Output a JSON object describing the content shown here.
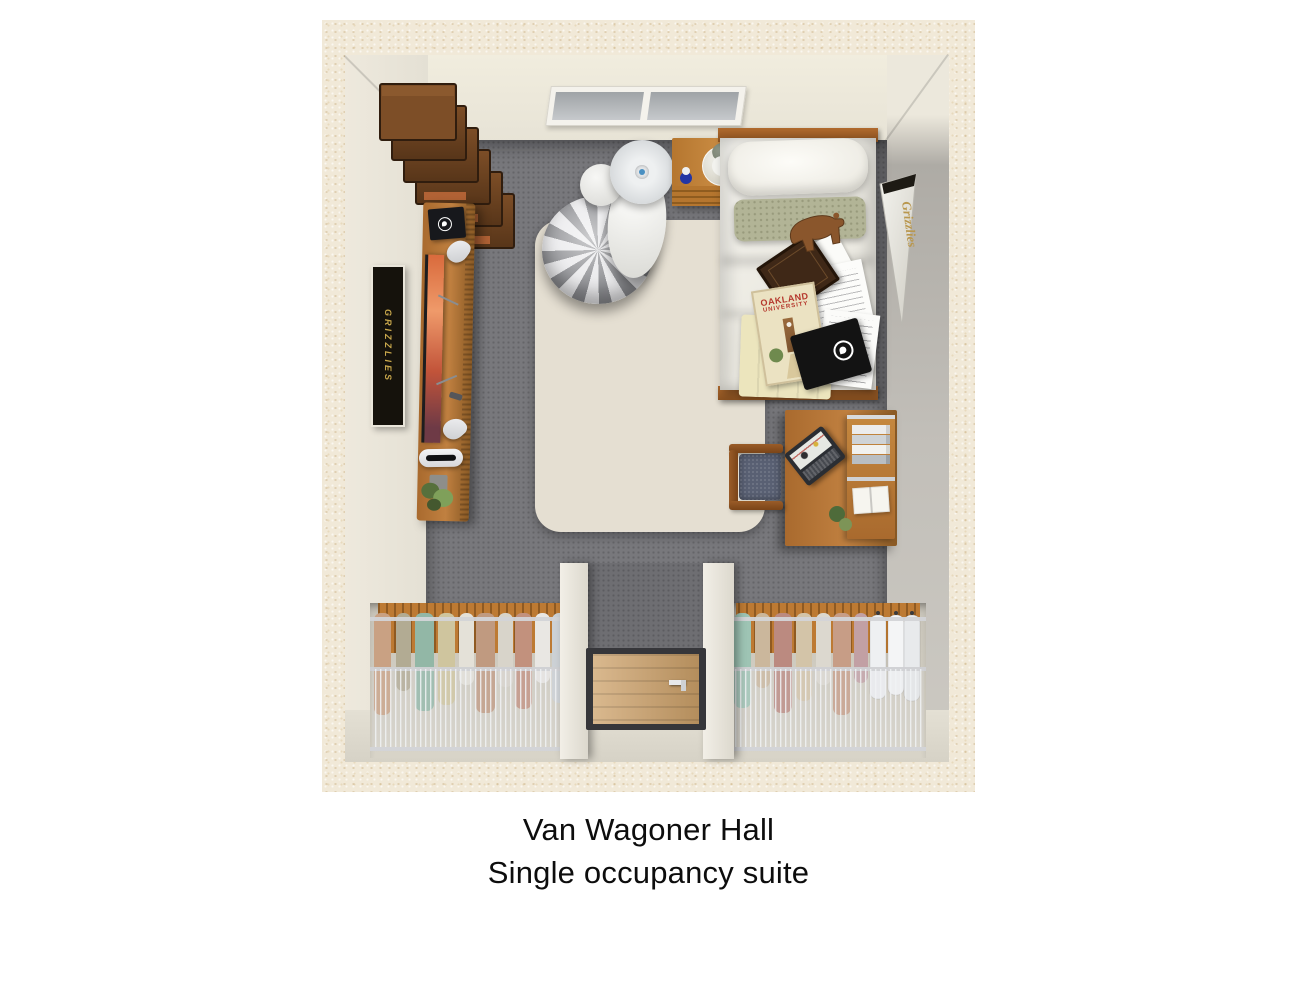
{
  "caption": {
    "line1": "Van Wagoner Hall",
    "line2": "Single occupancy suite"
  },
  "plan": {
    "university_book": {
      "line1": "OAKLAND",
      "line2": "UNIVERSITY"
    },
    "pennant_text": "Grizzlies",
    "wall_poster_text": "GRIZZLIES",
    "icons": {
      "speaker_logo": "grizzly-bear-logo",
      "notebook_logo": "grizzly-bear-logo"
    },
    "colors": {
      "page_background": "#ffffff",
      "matte_border": "#f1e9d8",
      "wall": "#ece8de",
      "right_wall": "#b9b6b0",
      "carpet": "#78787c",
      "area_rug": "#e5dfd2",
      "wood_furniture": "#b5722f",
      "bedding": "#f4f3ee",
      "sage_pillow": "#b2b496",
      "caption_text": "#0d0d0d"
    }
  }
}
